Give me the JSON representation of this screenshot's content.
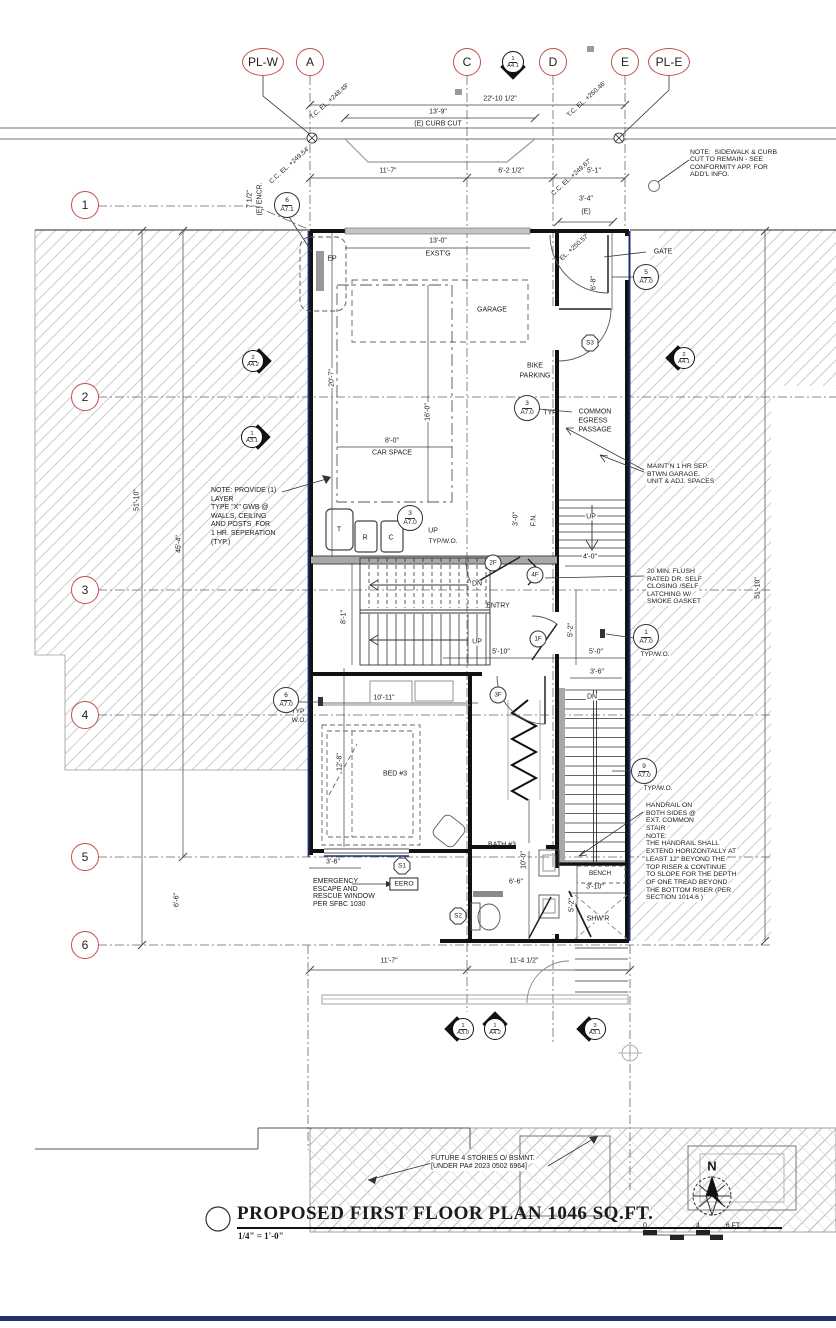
{
  "drawing": {
    "title": "PROPOSED FIRST FLOOR PLAN  1046 SQ.FT.",
    "scale": "1/4\" = 1'-0\"",
    "north_label": "N",
    "scale_bar": {
      "labels": [
        "0",
        "4",
        "6 FT"
      ]
    },
    "colors": {
      "grid_bubble": "#c0504d",
      "property_line": "#1c2f6e",
      "wall": "#111111",
      "hatch": "#cdcdcd",
      "accent_bar": "#24306b"
    }
  },
  "grid": {
    "top": [
      {
        "label": "PL-W",
        "x": 263
      },
      {
        "label": "A",
        "x": 310
      },
      {
        "label": "C",
        "x": 467
      },
      {
        "label": "D",
        "x": 553
      },
      {
        "label": "E",
        "x": 625
      },
      {
        "label": "PL-E",
        "x": 669
      }
    ],
    "left": [
      {
        "label": "1",
        "y": 205
      },
      {
        "label": "2",
        "y": 397
      },
      {
        "label": "3",
        "y": 590
      },
      {
        "label": "4",
        "y": 715
      },
      {
        "label": "5",
        "y": 857
      },
      {
        "label": "6",
        "y": 945
      }
    ]
  },
  "labels": [
    {
      "k": "dim",
      "t": "22'-10 1/2\"",
      "x": 500,
      "y": 99
    },
    {
      "k": "dim",
      "t": "13'-9\"",
      "x": 438,
      "y": 112
    },
    {
      "k": "dim",
      "t": "(E) CURB CUT",
      "x": 438,
      "y": 124
    },
    {
      "k": "dim",
      "t": "11'-7\"",
      "x": 388,
      "y": 171
    },
    {
      "k": "dim",
      "t": "6'-2 1/2\"",
      "x": 511,
      "y": 171
    },
    {
      "k": "dim",
      "t": "5'-1\"",
      "x": 594,
      "y": 171
    },
    {
      "k": "dim",
      "t": "3'-4\"",
      "x": 586,
      "y": 199
    },
    {
      "k": "dim",
      "t": "(E)",
      "x": 586,
      "y": 212
    },
    {
      "k": "dim",
      "t": "13'-0\"",
      "x": 438,
      "y": 241
    },
    {
      "k": "dim",
      "t": "EXST'G",
      "x": 438,
      "y": 254
    },
    {
      "k": "dim",
      "t": "6'-8\"",
      "x": 594,
      "y": 283,
      "r": -90
    },
    {
      "k": "dim",
      "t": "20'-7\"",
      "x": 332,
      "y": 378,
      "r": -90,
      "bg": 1
    },
    {
      "k": "dim",
      "t": "16'-0\"",
      "x": 428,
      "y": 412,
      "r": -90,
      "bg": 1
    },
    {
      "k": "dim",
      "t": "8'-0\"",
      "x": 392,
      "y": 441,
      "bg": 1
    },
    {
      "k": "dim",
      "t": "CAR SPACE",
      "x": 392,
      "y": 453
    },
    {
      "k": "dim",
      "t": "3'-0\"",
      "x": 516,
      "y": 519,
      "r": -90
    },
    {
      "k": "dim",
      "t": "F.N.",
      "x": 534,
      "y": 520,
      "r": -90
    },
    {
      "k": "dim",
      "t": "4'-0\"",
      "x": 590,
      "y": 557,
      "bg": 1
    },
    {
      "k": "dim",
      "t": "5'-10\"",
      "x": 501,
      "y": 652,
      "bg": 1
    },
    {
      "k": "dim",
      "t": "5'-0\"",
      "x": 596,
      "y": 652,
      "bg": 1
    },
    {
      "k": "dim",
      "t": "5'-2\"",
      "x": 571,
      "y": 630,
      "r": -90,
      "bg": 1
    },
    {
      "k": "dim",
      "t": "3'-6\"",
      "x": 597,
      "y": 672,
      "bg": 1
    },
    {
      "k": "dim",
      "t": "8'-1\"",
      "x": 344,
      "y": 617,
      "r": -90,
      "bg": 1
    },
    {
      "k": "dim",
      "t": "10'-11\"",
      "x": 384,
      "y": 698,
      "bg": 1
    },
    {
      "k": "dim",
      "t": "12'-8\"",
      "x": 340,
      "y": 762,
      "r": -90,
      "bg": 1
    },
    {
      "k": "dim",
      "t": "3'-6\"",
      "x": 333,
      "y": 862,
      "bg": 1
    },
    {
      "k": "dim",
      "t": "10'-0\"",
      "x": 524,
      "y": 860,
      "r": -90,
      "bg": 1
    },
    {
      "k": "dim",
      "t": "6'-6\"",
      "x": 516,
      "y": 882,
      "bg": 1
    },
    {
      "k": "dim",
      "t": "3'-10\"",
      "x": 595,
      "y": 887,
      "bg": 1
    },
    {
      "k": "dim",
      "t": "5'-2\"",
      "x": 572,
      "y": 905,
      "r": -90,
      "bg": 1
    },
    {
      "k": "dim",
      "t": "11'-7\"",
      "x": 389,
      "y": 961,
      "bg": 1
    },
    {
      "k": "dim",
      "t": "11'-4 1/2\"",
      "x": 524,
      "y": 961,
      "bg": 1
    },
    {
      "k": "dim",
      "t": "51'-10\"",
      "x": 137,
      "y": 500,
      "r": -90
    },
    {
      "k": "dim",
      "t": "45'-4\"",
      "x": 179,
      "y": 544,
      "r": -90
    },
    {
      "k": "dim",
      "t": "6'-6\"",
      "x": 177,
      "y": 900,
      "r": -90
    },
    {
      "k": "dim",
      "t": "51'-10\"",
      "x": 758,
      "y": 588,
      "r": -90
    },
    {
      "k": "dim",
      "t": "7 1/2\"",
      "x": 250,
      "y": 199,
      "r": -90
    },
    {
      "k": "dim",
      "t": "(E) ENCR.",
      "x": 260,
      "y": 199,
      "r": -90
    },
    {
      "k": "elev",
      "t": "T.C. EL. +248.49'",
      "x": 330,
      "y": 102
    },
    {
      "k": "elev",
      "t": "T.C. EL. +250.46'",
      "x": 587,
      "y": 100
    },
    {
      "k": "elev",
      "t": "C.C. EL. +249.54'",
      "x": 290,
      "y": 166
    },
    {
      "k": "elev",
      "t": "C.C. EL. +249.67'",
      "x": 572,
      "y": 178
    },
    {
      "k": "elev",
      "t": "EL. +250.57'",
      "x": 575,
      "y": 248
    },
    {
      "k": "room",
      "t": "GARAGE",
      "x": 492,
      "y": 310
    },
    {
      "k": "room",
      "t": "BIKE",
      "x": 535,
      "y": 366
    },
    {
      "k": "room",
      "t": "PARKING",
      "x": 535,
      "y": 376
    },
    {
      "k": "room",
      "t": "COMMON",
      "x": 595,
      "y": 412
    },
    {
      "k": "room",
      "t": "EGRESS",
      "x": 593,
      "y": 421
    },
    {
      "k": "room",
      "t": "PASSAGE",
      "x": 595,
      "y": 430
    },
    {
      "k": "room",
      "t": "ENTRY",
      "x": 498,
      "y": 606
    },
    {
      "k": "room",
      "t": "BED #3",
      "x": 395,
      "y": 774
    },
    {
      "k": "room",
      "t": "BATH #3",
      "x": 502,
      "y": 845
    },
    {
      "k": "room",
      "t": "SHW'R",
      "x": 598,
      "y": 919,
      "bg": 1
    },
    {
      "k": "room",
      "t": "BENCH",
      "x": 600,
      "y": 874,
      "fs": 6.3
    },
    {
      "k": "room",
      "t": "GATE",
      "x": 663,
      "y": 252,
      "bg": 1
    },
    {
      "k": "stair",
      "t": "UP",
      "x": 433,
      "y": 531,
      "bg": 1
    },
    {
      "k": "stair",
      "t": "UP",
      "x": 591,
      "y": 517,
      "bg": 1
    },
    {
      "k": "stair",
      "t": "DN",
      "x": 477,
      "y": 584,
      "bg": 1
    },
    {
      "k": "stair",
      "t": "UP",
      "x": 477,
      "y": 642,
      "bg": 1
    },
    {
      "k": "stair",
      "t": "DN",
      "x": 592,
      "y": 697,
      "bg": 1
    },
    {
      "k": "suffix",
      "t": "TYP",
      "x": 550,
      "y": 413
    },
    {
      "k": "suffix",
      "t": "TYP/W.O.",
      "x": 443,
      "y": 542,
      "fs": 6.5
    },
    {
      "k": "suffix",
      "t": "TYP",
      "x": 298,
      "y": 712,
      "fs": 6.5
    },
    {
      "k": "suffix",
      "t": "W.O.",
      "x": 299,
      "y": 721,
      "fs": 6.5
    },
    {
      "k": "suffix",
      "t": "TYP/W.O.",
      "x": 655,
      "y": 655,
      "fs": 6.5,
      "bg": 1
    },
    {
      "k": "suffix",
      "t": "TYP/W.O.",
      "x": 658,
      "y": 789,
      "fs": 6.5,
      "bg": 1
    }
  ],
  "notes": [
    {
      "id": "sidewalk-note",
      "x": 690,
      "y": 149,
      "lh": 7.4,
      "fs": 6.8,
      "lines": [
        "NOTE:  SIDEWALK & CURB",
        "CUT TO REMAIN - SEE",
        "CONFORMITY APP. FOR",
        "ADD'L INFO."
      ]
    },
    {
      "id": "gwb-note",
      "x": 211,
      "y": 487,
      "lh": 8.6,
      "fs": 7,
      "lines": [
        "NOTE: PROVIDE (1)",
        "LAYER",
        "TYPE \"X\" GWB @",
        "WALLS, CEILING",
        "AND POSTS  FOR",
        "1 HR. SEPERATION",
        "(TYP.)"
      ]
    },
    {
      "id": "maintain-note",
      "x": 646,
      "y": 463,
      "lh": 7.6,
      "fs": 6.8,
      "bg": 1,
      "lines": [
        "MAINT'N 1 HR SEP.",
        "BTWN GARAGE,",
        "UNIT & ADJ. SPACES"
      ]
    },
    {
      "id": "door-20min-note",
      "x": 646,
      "y": 568,
      "lh": 7.6,
      "fs": 6.8,
      "bg": 1,
      "lines": [
        "20 MIN. FLUSH",
        "RATED DR. SELF",
        "CLOSING /SELF",
        "LATCHING W/",
        "SMOKE GASKET"
      ]
    },
    {
      "id": "handrail-note",
      "x": 645,
      "y": 802,
      "lh": 7.7,
      "fs": 6.8,
      "bg": 1,
      "lines": [
        "HANDRAIL ON",
        "BOTH SIDES @",
        "EXT. COMMON",
        "STAIR",
        "NOTE:",
        "THE HANDRAIL SHALL",
        "EXTEND HORIZONTALLY AT",
        "LEAST 12\" BEYOND THE",
        "TOP RISER & CONTINUE",
        "TO SLOPE FOR THE DEPTH",
        "OF ONE TREAD BEYOND",
        "THE BOTTOM RISER (PER",
        "SECTION 1014.6 )"
      ]
    },
    {
      "id": "emergency-note",
      "x": 313,
      "y": 878,
      "lh": 7.7,
      "fs": 7,
      "lines": [
        "EMERGENCY",
        "ESCAPE AND",
        "RESCUE WINDOW",
        "PER SFBC 1030"
      ]
    },
    {
      "id": "future-note",
      "x": 430,
      "y": 1155,
      "lh": 8,
      "fs": 7,
      "bg": 1,
      "lines": [
        "FUTURE 4 STORIES O/ BSMNT.",
        "[UNDER PA# 2023 0502 6964]"
      ]
    }
  ],
  "callouts": [
    {
      "n": "6",
      "s": "A7.1",
      "x": 287,
      "y": 205
    },
    {
      "n": "5",
      "s": "A7.0",
      "x": 646,
      "y": 277
    },
    {
      "n": "3",
      "s": "A7.0",
      "x": 527,
      "y": 408
    },
    {
      "n": "3",
      "s": "A7.0",
      "x": 410,
      "y": 518
    },
    {
      "n": "1",
      "s": "A7.0",
      "x": 646,
      "y": 637
    },
    {
      "n": "6",
      "s": "A7.0",
      "x": 286,
      "y": 700
    },
    {
      "n": "9",
      "s": "A7.0",
      "x": 644,
      "y": 771
    }
  ],
  "sections": [
    {
      "n": "1",
      "s": "A4.1",
      "x": 513,
      "y": 62,
      "dir": "down"
    },
    {
      "n": "2",
      "s": "A4.2",
      "x": 253,
      "y": 361,
      "dir": "right"
    },
    {
      "n": "1",
      "s": "A3.1",
      "x": 252,
      "y": 437,
      "dir": "right"
    },
    {
      "n": "2",
      "s": "A4.1",
      "x": 684,
      "y": 358,
      "dir": "left"
    },
    {
      "n": "1",
      "s": "A3.0",
      "x": 463,
      "y": 1029,
      "dir": "left"
    },
    {
      "n": "1",
      "s": "A4.2",
      "x": 495,
      "y": 1029,
      "dir": "up"
    },
    {
      "n": "3",
      "s": "A3.1",
      "x": 595,
      "y": 1029,
      "dir": "left"
    }
  ],
  "tags": {
    "doors": [
      {
        "t": "2F",
        "x": 493,
        "y": 563
      },
      {
        "t": "4F",
        "x": 535,
        "y": 575
      },
      {
        "t": "1F",
        "x": 538,
        "y": 639
      },
      {
        "t": "3F",
        "x": 498,
        "y": 695
      }
    ],
    "windows": [
      {
        "t": "S1",
        "x": 402,
        "y": 866
      },
      {
        "t": "S2",
        "x": 458,
        "y": 916
      },
      {
        "t": "S3",
        "x": 590,
        "y": 343
      }
    ],
    "eero": {
      "t": "EERO",
      "x": 404,
      "y": 884
    },
    "ep": {
      "t": "EP",
      "x": 332,
      "y": 259
    },
    "bins": [
      {
        "t": "T",
        "x": 339,
        "y": 530
      },
      {
        "t": "R",
        "x": 365,
        "y": 538
      },
      {
        "t": "C",
        "x": 391,
        "y": 538
      }
    ]
  }
}
